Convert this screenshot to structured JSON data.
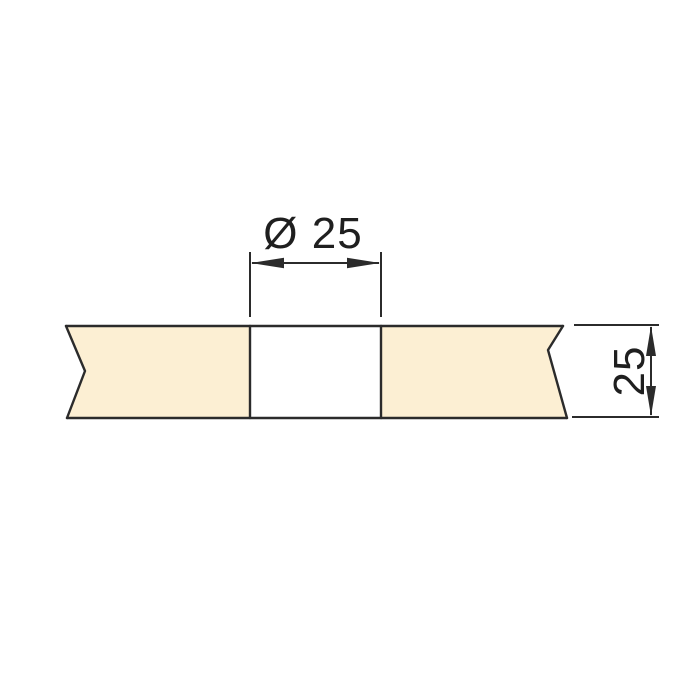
{
  "drawing": {
    "colors": {
      "background": "#ffffff",
      "panel_fill": "#fcefd3",
      "hole_fill": "#ffffff",
      "line": "#2b2b2b",
      "text": "#1f1f1f"
    },
    "dimensions": {
      "hole_diameter": {
        "label": "Ø 25",
        "value": 25,
        "symbol": "Ø"
      },
      "thickness": {
        "label": "25",
        "value": 25
      }
    }
  }
}
